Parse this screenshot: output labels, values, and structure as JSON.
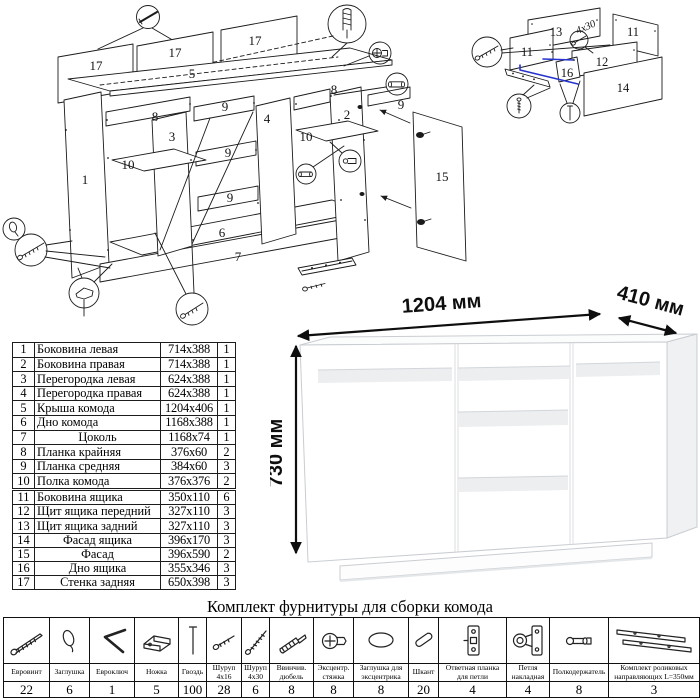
{
  "hardware_title": "Комплект фурнитуры для сборки комода",
  "assembly_diagram": {
    "part_labels": [
      {
        "t": "17",
        "x": 96,
        "y": 70
      },
      {
        "t": "17",
        "x": 175,
        "y": 57
      },
      {
        "t": "17",
        "x": 255,
        "y": 45
      },
      {
        "t": "5",
        "x": 192,
        "y": 78
      },
      {
        "t": "8",
        "x": 155,
        "y": 121
      },
      {
        "t": "8",
        "x": 334,
        "y": 94
      },
      {
        "t": "9",
        "x": 225,
        "y": 111
      },
      {
        "t": "9",
        "x": 228,
        "y": 157
      },
      {
        "t": "9",
        "x": 230,
        "y": 202
      },
      {
        "t": "9",
        "x": 401,
        "y": 109
      },
      {
        "t": "3",
        "x": 172,
        "y": 141
      },
      {
        "t": "4",
        "x": 267,
        "y": 123
      },
      {
        "t": "2",
        "x": 347,
        "y": 119
      },
      {
        "t": "1",
        "x": 85,
        "y": 184
      },
      {
        "t": "10",
        "x": 128,
        "y": 169
      },
      {
        "t": "10",
        "x": 306,
        "y": 141
      },
      {
        "t": "6",
        "x": 222,
        "y": 237
      },
      {
        "t": "7",
        "x": 238,
        "y": 261
      },
      {
        "t": "15",
        "x": 442,
        "y": 181
      }
    ],
    "callout_icons": [
      "nail-icon",
      "screw-in-dowel-icon",
      "eccentric-cam-icon",
      "dowel-icon",
      "shelf-support-icon",
      "dowel-icon",
      "plug-icon",
      "confirmat-screw-icon",
      "foot-icon",
      "confirmat-screw-icon"
    ]
  },
  "drawer_diagram": {
    "part_labels": [
      {
        "t": "13",
        "x": 96,
        "y": 36
      },
      {
        "t": "11",
        "x": 173,
        "y": 36
      },
      {
        "t": "11",
        "x": 67,
        "y": 56
      },
      {
        "t": "12",
        "x": 142,
        "y": 66
      },
      {
        "t": "16",
        "x": 107,
        "y": 77
      },
      {
        "t": "14",
        "x": 163,
        "y": 92
      }
    ],
    "screw_note": "4х30",
    "callout_icons": [
      "confirmat-screw-icon",
      "screw-icon",
      "nail-icon",
      "screw-icon"
    ]
  },
  "render_dimensions": {
    "width": "1204 мм",
    "depth": "410 мм",
    "height": "730 мм"
  },
  "parts_table": {
    "sections": [
      {
        "rows": [
          {
            "num": "1",
            "name": "Боковина левая",
            "size": "714x388",
            "qty": "1",
            "align": "left"
          },
          {
            "num": "2",
            "name": "Боковина правая",
            "size": "714x388",
            "qty": "1",
            "align": "left"
          },
          {
            "num": "3",
            "name": "Перегородка левая",
            "size": "624x388",
            "qty": "1",
            "align": "left"
          },
          {
            "num": "4",
            "name": "Перегородка правая",
            "size": "624x388",
            "qty": "1",
            "align": "left"
          },
          {
            "num": "5",
            "name": "Крыша комода",
            "size": "1204x406",
            "qty": "1",
            "align": "left"
          },
          {
            "num": "6",
            "name": "Дно комода",
            "size": "1168x388",
            "qty": "1",
            "align": "left"
          },
          {
            "num": "7",
            "name": "Цоколь",
            "size": "1168x74",
            "qty": "1",
            "align": "center"
          },
          {
            "num": "8",
            "name": "Планка крайняя",
            "size": "376x60",
            "qty": "2",
            "align": "left"
          },
          {
            "num": "9",
            "name": "Планка средняя",
            "size": "384x60",
            "qty": "3",
            "align": "left"
          },
          {
            "num": "10",
            "name": "Полка комода",
            "size": "376x376",
            "qty": "2",
            "align": "left"
          }
        ]
      },
      {
        "rows": [
          {
            "num": "11",
            "name": "Боковина ящика",
            "size": "350x110",
            "qty": "6",
            "align": "left"
          },
          {
            "num": "12",
            "name": "Щит ящика передний",
            "size": "327x110",
            "qty": "3",
            "align": "left"
          },
          {
            "num": "13",
            "name": "Щит ящика задний",
            "size": "327x110",
            "qty": "3",
            "align": "left"
          },
          {
            "num": "14",
            "name": "Фасад ящика",
            "size": "396x170",
            "qty": "3",
            "align": "center"
          },
          {
            "num": "15",
            "name": "Фасад",
            "size": "396x590",
            "qty": "2",
            "align": "center"
          },
          {
            "num": "16",
            "name": "Дно ящика",
            "size": "355x346",
            "qty": "3",
            "align": "center"
          },
          {
            "num": "17",
            "name": "Стенка задняя",
            "size": "650x398",
            "qty": "3",
            "align": "center"
          }
        ]
      }
    ]
  },
  "hardware_table": {
    "items": [
      {
        "label": "Евровинт",
        "qty": "22",
        "icon": "confirmat-screw-icon"
      },
      {
        "label": "Заглушка",
        "qty": "6",
        "icon": "plug-cap-icon"
      },
      {
        "label": "Евроключ",
        "qty": "1",
        "icon": "hex-key-icon"
      },
      {
        "label": "Ножка",
        "qty": "5",
        "icon": "foot-icon"
      },
      {
        "label": "Гвоздь",
        "qty": "100",
        "icon": "nail-icon"
      },
      {
        "label": "Шуруп 4х16",
        "qty": "28",
        "icon": "screw-small-icon"
      },
      {
        "label": "Шуруп 4х30",
        "qty": "6",
        "icon": "screw-long-icon"
      },
      {
        "label": "Ввинчив. дюбель",
        "qty": "8",
        "icon": "screw-in-dowel-icon"
      },
      {
        "label": "Эксцентр. стяжка",
        "qty": "8",
        "icon": "eccentric-cam-icon"
      },
      {
        "label": "Заглушка для эксцентрика",
        "qty": "8",
        "icon": "oval-plug-icon"
      },
      {
        "label": "Шкант",
        "qty": "20",
        "icon": "dowel-icon"
      },
      {
        "label": "Ответная планка для петли",
        "qty": "4",
        "icon": "hinge-plate-icon"
      },
      {
        "label": "Петля накладная",
        "qty": "4",
        "icon": "hinge-icon"
      },
      {
        "label": "Полкодержатель",
        "qty": "8",
        "icon": "shelf-support-icon"
      },
      {
        "label": "Комплект роликовых направляющих L=350мм",
        "qty": "3",
        "icon": "roller-guides-icon"
      }
    ]
  }
}
